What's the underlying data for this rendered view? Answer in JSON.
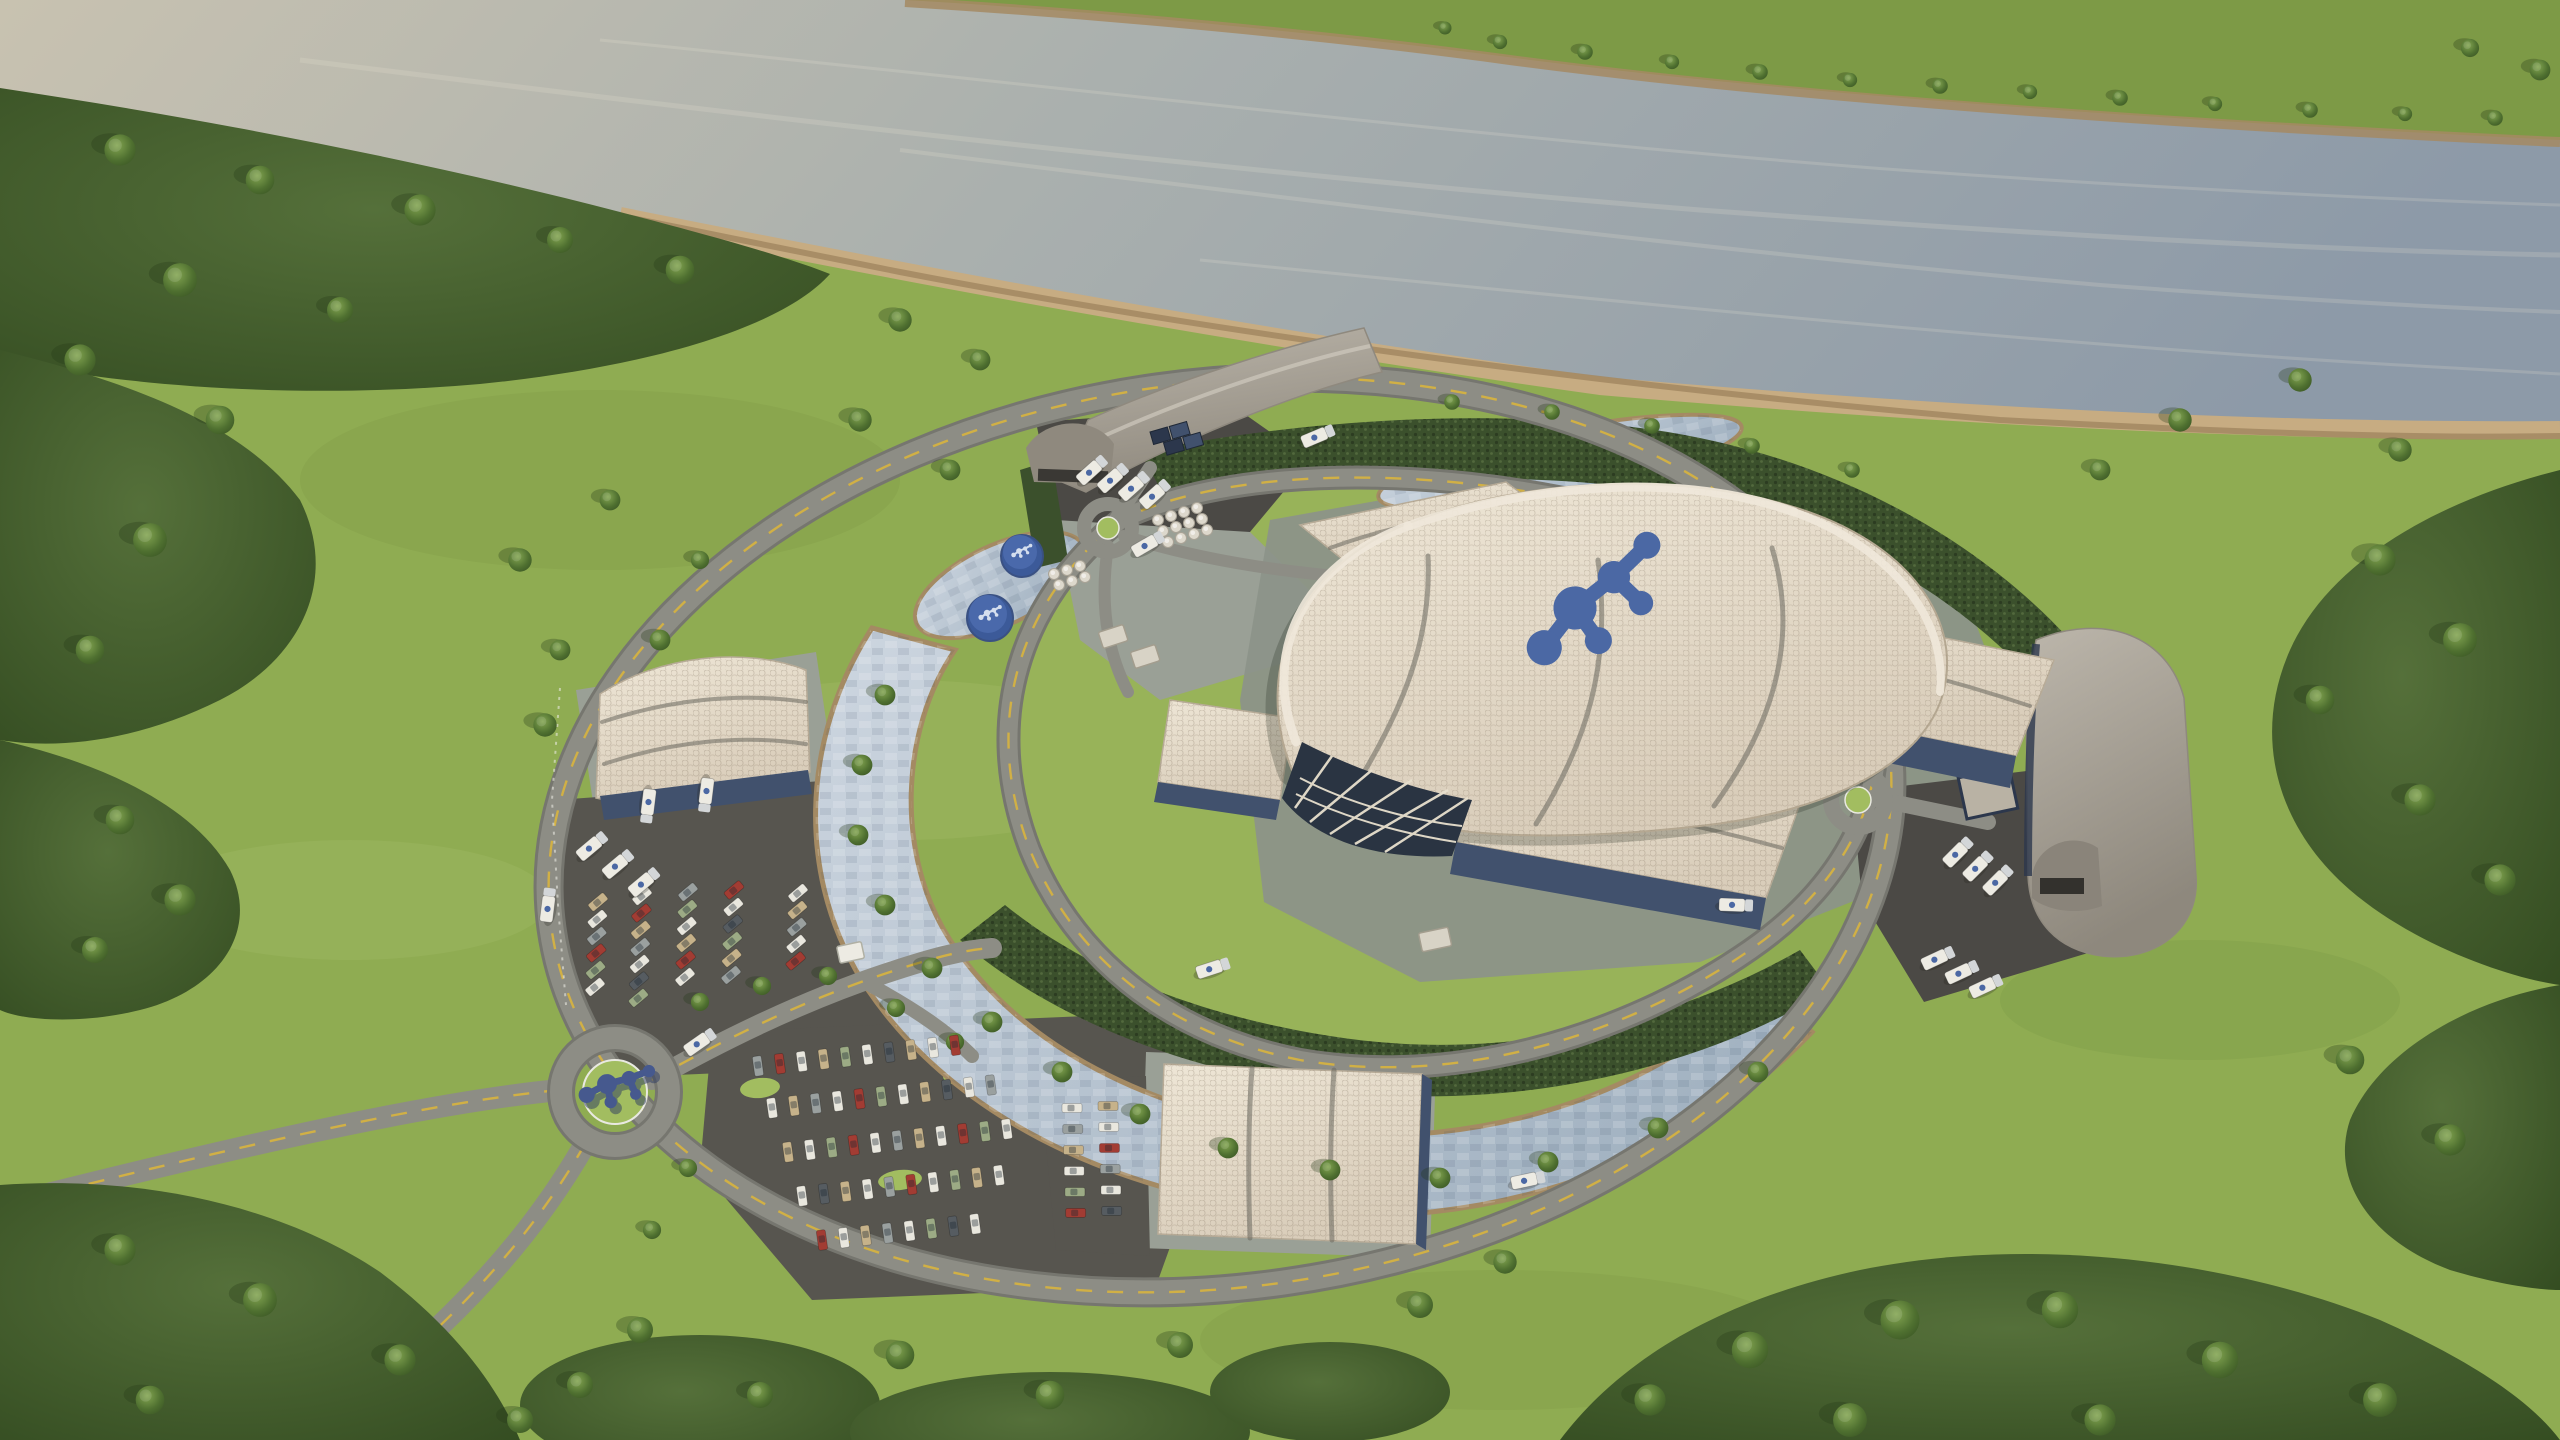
{
  "meta": {
    "title": "Aerial 3D architectural rendering of a small modular reactor power plant campus beside a river",
    "render_type": "photoreal-3d-aerial",
    "no_visible_text": true
  },
  "colors": {
    "g1": "#8fac52",
    "g2": "#a2bd60",
    "g3": "#b6cb76",
    "g4": "#7d9a46",
    "forest": "#4a672f",
    "forestD": "#31491f",
    "hedge": "#3b502c",
    "water1": "#c8c2b0",
    "water2": "#8d9aa8",
    "sand": "#c7ac82",
    "sandD": "#a48a63",
    "road": "#8d8d85",
    "roadD": "#76766f",
    "asphalt": "#4b4945",
    "lot": "#57554f",
    "concrete": "#9aa096",
    "plaza": "#8c9389",
    "cream": "#ded2c0",
    "creamL": "#f0e8da",
    "seam": "#6a675f",
    "gray1": "#b2aca1",
    "gray2": "#8f897e",
    "navy": "#41516d",
    "navyD": "#2c374c",
    "glass": "#2a3442",
    "mullion": "#e8e0ce",
    "blue": "#4b68a4",
    "blueD": "#3a5183",
    "tank": "#3c5a99",
    "white": "#edebe3",
    "cab": "#d3d6d8",
    "stone": "#c4ceda",
    "stoneD": "#9dafc0",
    "carW": "#e9e7de",
    "carG": "#9aa09f",
    "carT": "#c6b28a",
    "carR": "#a23c33",
    "carS": "#9cab85",
    "carK": "#565c61",
    "lineY": "#d8b43e",
    "lineW": "#e9e9e1"
  },
  "scene": {
    "objects": [
      "river with wooded far bank",
      "riverside forest",
      "open meadow",
      "oval perimeter ring road",
      "inner campus loop road",
      "stone-lined cooling channel",
      "landscape ponds",
      "dense security hedges",
      "central reactor hall with wavy hexagonal-tile shell roof and blue molecule logo",
      "turbine halls with cream wavy roofs and navy walls",
      "north curved warehouse with loading dock",
      "east curved warehouse with truck yard",
      "west logistics building",
      "visitor center",
      "blue storage tanks with logo tops",
      "white cask storage pads",
      "navy container stack",
      "gatehouse",
      "staff parking lot",
      "visitor parking lot",
      "entrance roundabout with blue logo sculpture",
      "tanker trucks",
      "passenger cars"
    ],
    "logo": {
      "style": "connected-molecule-nodes",
      "color": "#4b68a4"
    },
    "trees": [
      [
        120,
        150,
        1.2
      ],
      [
        260,
        180,
        1.1
      ],
      [
        420,
        210,
        1.2
      ],
      [
        560,
        240,
        1.0
      ],
      [
        680,
        270,
        1.1
      ],
      [
        180,
        280,
        1.3
      ],
      [
        340,
        310,
        1.0
      ],
      [
        80,
        360,
        1.2
      ],
      [
        220,
        420,
        1.1
      ],
      [
        150,
        540,
        1.3
      ],
      [
        90,
        650,
        1.1
      ],
      [
        120,
        820,
        1.1
      ],
      [
        180,
        900,
        1.2
      ],
      [
        95,
        950,
        1.0
      ],
      [
        120,
        1250,
        1.2
      ],
      [
        260,
        1300,
        1.3
      ],
      [
        400,
        1360,
        1.2
      ],
      [
        150,
        1400,
        1.1
      ],
      [
        520,
        1420,
        1.0
      ],
      [
        2380,
        560,
        1.2
      ],
      [
        2460,
        640,
        1.3
      ],
      [
        2320,
        700,
        1.1
      ],
      [
        2420,
        800,
        1.2
      ],
      [
        2500,
        880,
        1.2
      ],
      [
        2350,
        1060,
        1.1
      ],
      [
        2450,
        1140,
        1.2
      ],
      [
        1750,
        1350,
        1.4
      ],
      [
        1900,
        1320,
        1.5
      ],
      [
        2060,
        1310,
        1.4
      ],
      [
        2220,
        1360,
        1.4
      ],
      [
        2380,
        1400,
        1.3
      ],
      [
        1650,
        1400,
        1.2
      ],
      [
        2100,
        1420,
        1.2
      ],
      [
        1850,
        1420,
        1.3
      ],
      [
        520,
        560,
        0.9
      ],
      [
        560,
        650,
        0.8
      ],
      [
        545,
        725,
        0.9
      ],
      [
        610,
        500,
        0.8
      ],
      [
        700,
        560,
        0.7
      ],
      [
        660,
        640,
        0.8
      ],
      [
        900,
        320,
        0.9
      ],
      [
        980,
        360,
        0.8
      ],
      [
        860,
        420,
        0.9
      ],
      [
        950,
        470,
        0.8
      ],
      [
        2180,
        420,
        0.9
      ],
      [
        2300,
        380,
        0.9
      ],
      [
        2100,
        470,
        0.8
      ],
      [
        2400,
        450,
        0.9
      ],
      [
        885,
        695,
        0.8
      ],
      [
        862,
        765,
        0.8
      ],
      [
        858,
        835,
        0.8
      ],
      [
        885,
        905,
        0.8
      ],
      [
        932,
        968,
        0.8
      ],
      [
        992,
        1022,
        0.8
      ],
      [
        1062,
        1072,
        0.8
      ],
      [
        1140,
        1114,
        0.8
      ],
      [
        1228,
        1148,
        0.8
      ],
      [
        1330,
        1170,
        0.8
      ],
      [
        1440,
        1178,
        0.8
      ],
      [
        1548,
        1162,
        0.8
      ],
      [
        1658,
        1128,
        0.8
      ],
      [
        1758,
        1072,
        0.8
      ],
      [
        700,
        1002,
        0.7
      ],
      [
        762,
        986,
        0.7
      ],
      [
        828,
        976,
        0.7
      ],
      [
        896,
        1008,
        0.7
      ],
      [
        955,
        1042,
        0.7
      ],
      [
        688,
        1168,
        0.7
      ],
      [
        652,
        1230,
        0.7
      ],
      [
        1500,
        42,
        0.55
      ],
      [
        1585,
        52,
        0.6
      ],
      [
        1672,
        62,
        0.55
      ],
      [
        1760,
        72,
        0.6
      ],
      [
        1850,
        80,
        0.55
      ],
      [
        1940,
        86,
        0.6
      ],
      [
        2030,
        92,
        0.55
      ],
      [
        2120,
        98,
        0.6
      ],
      [
        2215,
        104,
        0.55
      ],
      [
        2310,
        110,
        0.6
      ],
      [
        2405,
        114,
        0.55
      ],
      [
        2495,
        118,
        0.6
      ],
      [
        2540,
        70,
        0.8
      ],
      [
        2470,
        48,
        0.7
      ],
      [
        1445,
        28,
        0.5
      ],
      [
        640,
        1330,
        1.0
      ],
      [
        580,
        1385,
        1.0
      ],
      [
        900,
        1355,
        1.1
      ],
      [
        1180,
        1345,
        1.0
      ],
      [
        1420,
        1305,
        1.0
      ],
      [
        1505,
        1262,
        0.9
      ],
      [
        1050,
        1395,
        1.1
      ],
      [
        760,
        1395,
        1.0
      ],
      [
        1452,
        402,
        0.6
      ],
      [
        1552,
        412,
        0.6
      ],
      [
        1652,
        426,
        0.6
      ],
      [
        1752,
        446,
        0.6
      ],
      [
        1852,
        470,
        0.6
      ]
    ],
    "trucks": [
      [
        548,
        905,
        -83
      ],
      [
        1318,
        436,
        -23
      ],
      [
        1528,
        1180,
        -12
      ],
      [
        1736,
        905,
        2
      ],
      [
        1213,
        968,
        -18
      ],
      [
        700,
        1042,
        -35
      ],
      [
        1148,
        544,
        -30
      ],
      [
        1092,
        470,
        -42
      ],
      [
        1113,
        478,
        -42
      ],
      [
        1134,
        486,
        -42
      ],
      [
        1155,
        494,
        -42
      ],
      [
        1958,
        852,
        -45
      ],
      [
        1978,
        866,
        -45
      ],
      [
        1998,
        880,
        -45
      ],
      [
        1938,
        958,
        -25
      ],
      [
        1962,
        972,
        -25
      ],
      [
        1986,
        986,
        -25
      ],
      [
        648,
        806,
        97
      ],
      [
        706,
        795,
        97
      ],
      [
        592,
        846,
        -40
      ],
      [
        618,
        864,
        -40
      ],
      [
        644,
        882,
        -40
      ]
    ],
    "car_rows": [
      {
        "x": 598,
        "y": 902,
        "dir": 92,
        "spacing": 17,
        "count": 6,
        "carAngle": -40,
        "colors": [
          "carT",
          "carW",
          "carG",
          "carR",
          "carS",
          "carW"
        ]
      },
      {
        "x": 642,
        "y": 896,
        "dir": 92,
        "spacing": 17,
        "count": 7,
        "carAngle": -40,
        "colors": [
          "carW",
          "carR",
          "carT",
          "carG",
          "carW",
          "carK",
          "carS"
        ]
      },
      {
        "x": 688,
        "y": 892,
        "dir": 92,
        "spacing": 17,
        "count": 6,
        "carAngle": -40,
        "colors": [
          "carG",
          "carS",
          "carW",
          "carT",
          "carR",
          "carW"
        ]
      },
      {
        "x": 734,
        "y": 890,
        "dir": 92,
        "spacing": 17,
        "count": 6,
        "carAngle": -40,
        "colors": [
          "carR",
          "carW",
          "carK",
          "carS",
          "carT",
          "carG"
        ]
      },
      {
        "x": 798,
        "y": 893,
        "dir": 92,
        "spacing": 17,
        "count": 5,
        "carAngle": -40,
        "colors": [
          "carW",
          "carT",
          "carG",
          "carW",
          "carR"
        ]
      },
      {
        "x": 758,
        "y": 1066,
        "dir": -6,
        "spacing": 22,
        "count": 10,
        "carAngle": 82,
        "colors": [
          "carG",
          "carR",
          "carW",
          "carT",
          "carS",
          "carW",
          "carK",
          "carT",
          "carW",
          "carR"
        ]
      },
      {
        "x": 772,
        "y": 1108,
        "dir": -6,
        "spacing": 22,
        "count": 11,
        "carAngle": 82,
        "colors": [
          "carW",
          "carT",
          "carG",
          "carW",
          "carR",
          "carS",
          "carW",
          "carT",
          "carK",
          "carW",
          "carG"
        ]
      },
      {
        "x": 788,
        "y": 1152,
        "dir": -6,
        "spacing": 22,
        "count": 11,
        "carAngle": 82,
        "colors": [
          "carT",
          "carW",
          "carS",
          "carR",
          "carW",
          "carG",
          "carT",
          "carW",
          "carR",
          "carS",
          "carW"
        ]
      },
      {
        "x": 802,
        "y": 1196,
        "dir": -6,
        "spacing": 22,
        "count": 10,
        "carAngle": 82,
        "colors": [
          "carW",
          "carK",
          "carT",
          "carW",
          "carG",
          "carR",
          "carW",
          "carS",
          "carT",
          "carW"
        ]
      },
      {
        "x": 822,
        "y": 1240,
        "dir": -6,
        "spacing": 22,
        "count": 8,
        "carAngle": 82,
        "colors": [
          "carR",
          "carW",
          "carT",
          "carG",
          "carW",
          "carS",
          "carK",
          "carW"
        ]
      },
      {
        "x": 1072,
        "y": 1108,
        "dir": 88,
        "spacing": 21,
        "count": 6,
        "carAngle": 0,
        "colors": [
          "carW",
          "carG",
          "carT",
          "carW",
          "carS",
          "carR"
        ]
      },
      {
        "x": 1108,
        "y": 1106,
        "dir": 88,
        "spacing": 21,
        "count": 6,
        "carAngle": 0,
        "colors": [
          "carT",
          "carW",
          "carR",
          "carG",
          "carW",
          "carK"
        ]
      }
    ],
    "cask_pads": [
      {
        "x": 1158,
        "y": 520,
        "cols": 4,
        "rows": 3,
        "colStep": [
          13,
          -4
        ],
        "rowStep": [
          5,
          11
        ]
      },
      {
        "x": 1054,
        "y": 574,
        "cols": 3,
        "rows": 2,
        "colStep": [
          13,
          -4
        ],
        "rowStep": [
          5,
          11
        ]
      }
    ]
  }
}
